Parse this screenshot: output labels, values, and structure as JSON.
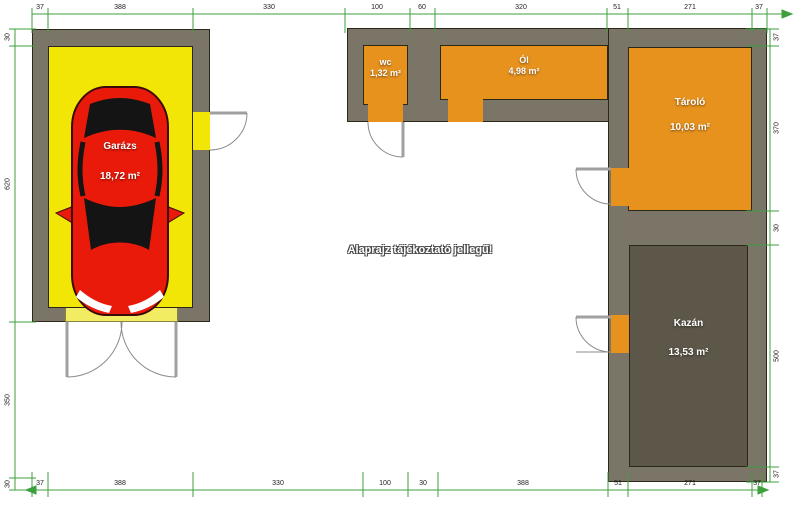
{
  "annotation": "Alaprajz tájékoztató jellegű!",
  "rooms": {
    "garazs": {
      "name": "Garázs",
      "area": "18,72 m²"
    },
    "wc": {
      "name": "wc",
      "area": "1,32 m²"
    },
    "ol": {
      "name": "Ól",
      "area": "4,98 m²"
    },
    "tarolo": {
      "name": "Tároló",
      "area": "10,03 m²"
    },
    "kazan": {
      "name": "Kazán",
      "area": "13,53 m²"
    }
  },
  "dimensions": {
    "top": [
      "37",
      "388",
      "330",
      "100",
      "60",
      "320",
      "51",
      "271",
      "37"
    ],
    "bottom": [
      "37",
      "388",
      "330",
      "100",
      "30",
      "388",
      "51",
      "271",
      "37"
    ],
    "left": [
      "30",
      "620",
      "350",
      "30"
    ],
    "right": [
      "37",
      "370",
      "30",
      "500",
      "37"
    ]
  },
  "colors": {
    "wall": "#7b7567",
    "outline": "#2b2817",
    "room_orange": "#e8921e",
    "garage_yellow": "#f1e606",
    "threshold_yellow": "#f2ec62",
    "kazan_floor": "#5d574a",
    "car_red": "#ea1a0a",
    "dimension_green": "#3da03d",
    "background": "#ffffff"
  }
}
